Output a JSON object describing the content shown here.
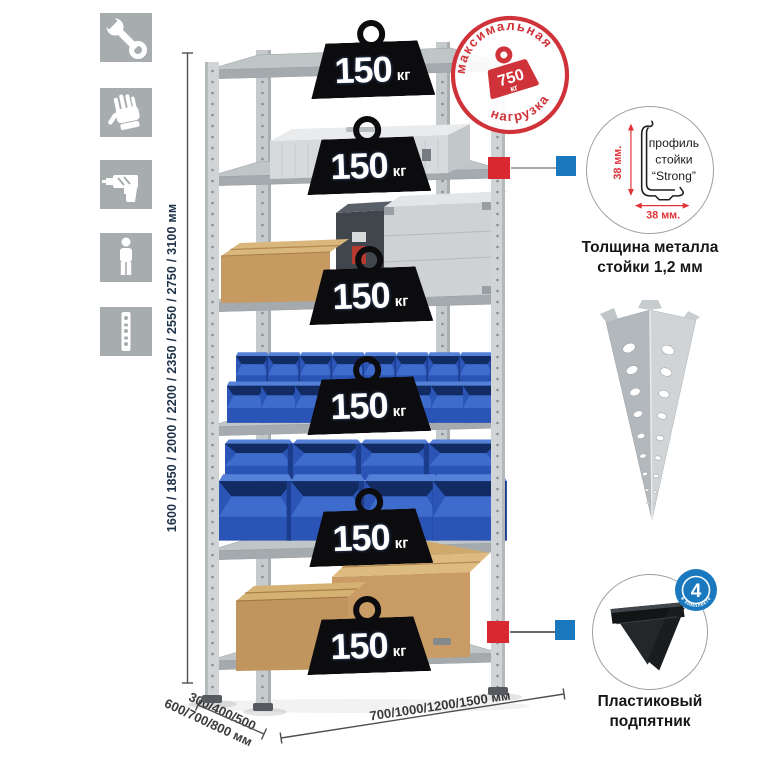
{
  "colors": {
    "accent_red": "#cf3339",
    "accent_blue": "#1a78be",
    "structure_gray": "#c5cacc",
    "bin_blue": "#2d5bbd",
    "icon_tile_gray": "#a7acaf"
  },
  "sidebar_icons": [
    {
      "name": "wrench"
    },
    {
      "name": "work-gloves"
    },
    {
      "name": "drill"
    },
    {
      "name": "person"
    },
    {
      "name": "perforated-post"
    }
  ],
  "rack": {
    "shelves_count": 6,
    "badges": [
      {
        "value": "150",
        "unit": "кг"
      },
      {
        "value": "150",
        "unit": "кг"
      },
      {
        "value": "150",
        "unit": "кг"
      },
      {
        "value": "150",
        "unit": "кг"
      },
      {
        "value": "150",
        "unit": "кг"
      },
      {
        "value": "150",
        "unit": "кг"
      }
    ]
  },
  "max_load_stamp": {
    "top_text": "максимальная",
    "bottom_text": "нагрузка",
    "weight_value": "750",
    "weight_unit": "кг"
  },
  "dimensions": {
    "height_label": "1600 / 1850 / 2000 / 2200 / 2350 / 2550 / 2750 / 3100 мм",
    "depth_label_line1": "300/400/500",
    "depth_label_line2": "600/700/800 мм",
    "width_label": "700/1000/1200/1500 мм"
  },
  "profile_detail": {
    "label_line1": "профиль",
    "label_line2": "стойки",
    "label_line3": "“Strong”",
    "dim_vertical": "38 мм.",
    "dim_horizontal": "38 мм.",
    "caption_line1": "Толщина металла",
    "caption_line2": "стойки 1,2 мм"
  },
  "foot_detail": {
    "badge_count": "4",
    "badge_ring_text": "в комплекте",
    "caption_line1": "Пластиковый",
    "caption_line2": "подпятник"
  }
}
